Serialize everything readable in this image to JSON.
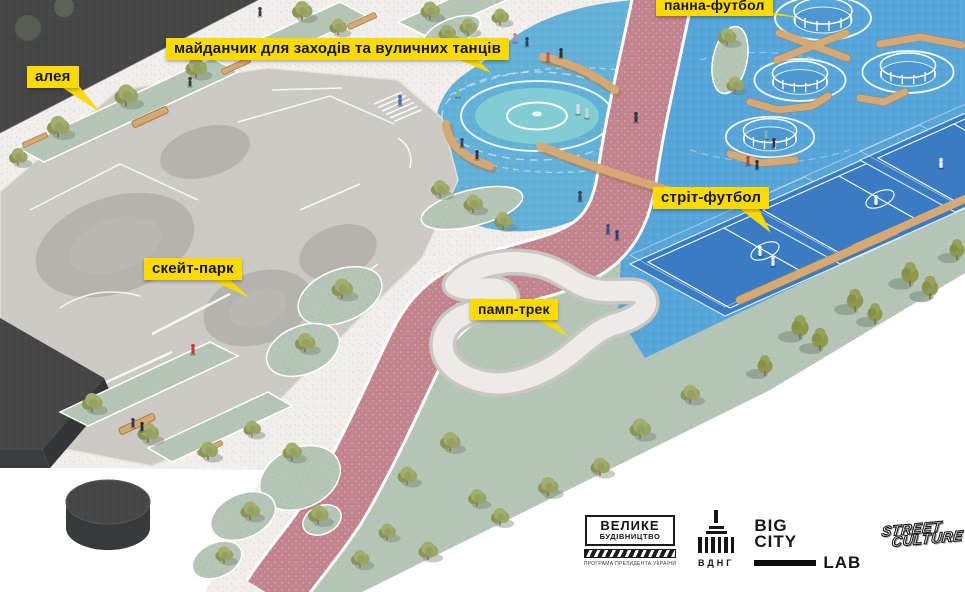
{
  "page": {
    "background": "#ffffff",
    "canvas_width": 965,
    "canvas_height": 592
  },
  "labels": {
    "panna_football": "панна-футбол",
    "events_area": "майданчик для заходів та вуличних танців",
    "alley": "алея",
    "street_football": "стріт-футбол",
    "skate_park": "скейт-парк",
    "pump_track": "памп-трек"
  },
  "legend_colors": {
    "label_yellow": "#fbda00",
    "path_pink": "#c2838d",
    "court_blue": "#3a7cc4",
    "water_blue": "#58a5d9",
    "plaza_blue": "#64b1d8",
    "lawn_green": "#b5c6b7",
    "concrete_gray": "#cbcac5",
    "wood_tan": "#d6a974",
    "dark_block": "#464646"
  },
  "footer": {
    "velyke_budivnytstvo": {
      "line1": "ВЕЛИКЕ",
      "line2": "БУДІВНИЦТВО",
      "subtext": "ПРОГРАМА ПРЕЗИДЕНТА УКРАЇНИ"
    },
    "vdnh": {
      "label": "ВДНГ"
    },
    "big_city_lab": {
      "big": "BIG",
      "city": "CITY",
      "lab": "LAB"
    },
    "street_culture": {
      "line1": "STREET",
      "line2": "CULTURE"
    }
  }
}
